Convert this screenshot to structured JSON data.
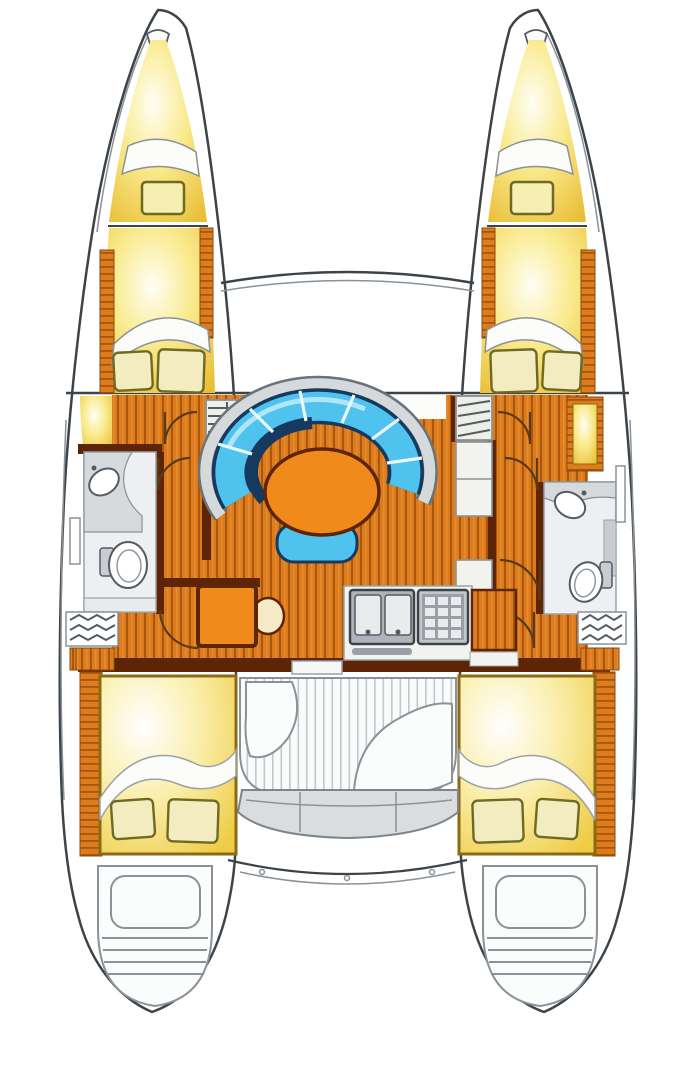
{
  "diagram": {
    "type": "boat-floor-plan",
    "subject": "sailing catamaran interior layout, top-down view",
    "hulls": 2,
    "rooms": [
      {
        "id": "port-forepeak",
        "contents": [
          "anchor-locker-lid",
          "deck-hatch"
        ]
      },
      {
        "id": "starboard-forepeak",
        "contents": [
          "anchor-locker-lid",
          "deck-hatch"
        ]
      },
      {
        "id": "port-forward-cabin",
        "contents": [
          "v-berth",
          "blanket",
          "two-pillows"
        ]
      },
      {
        "id": "starboard-forward-cabin",
        "contents": [
          "v-berth",
          "blanket",
          "two-pillows"
        ]
      },
      {
        "id": "port-head",
        "contents": [
          "sink",
          "counter",
          "toilet"
        ]
      },
      {
        "id": "starboard-head",
        "contents": [
          "sink",
          "counter",
          "toilet"
        ]
      },
      {
        "id": "salon",
        "contents": [
          "curved-settee",
          "oval-table",
          "bench-seat",
          "plank-floor"
        ]
      },
      {
        "id": "nav-station",
        "contents": [
          "chart-table",
          "stool"
        ]
      },
      {
        "id": "galley",
        "contents": [
          "double-sink",
          "stove-grid",
          "counter",
          "cabinet"
        ]
      },
      {
        "id": "port-aft-cabin",
        "contents": [
          "double-berth",
          "sheet-fold",
          "two-pillows"
        ]
      },
      {
        "id": "starboard-aft-cabin",
        "contents": [
          "double-berth",
          "sheet-fold",
          "two-pillows"
        ]
      },
      {
        "id": "cockpit",
        "contents": [
          "slatted-sole",
          "side-seats",
          "transverse-bench"
        ]
      },
      {
        "id": "port-transom",
        "contents": [
          "locker",
          "swim-steps"
        ]
      },
      {
        "id": "starboard-transom",
        "contents": [
          "locker",
          "swim-steps"
        ]
      }
    ],
    "exterior_features": [
      "front-crossbeam",
      "foredeck-gap-between-hulls",
      "aft-beam-with-fittings"
    ]
  },
  "colors": {
    "hull_line": "#3D4449",
    "line_soft": "#8A9298",
    "wood": "#DC7C1C",
    "wood_dark": "#A8560E",
    "wood_light": "#F09A40",
    "wall_brown": "#5E2406",
    "cabin_yellow": "#F3D54F",
    "cabin_yellow_deep": "#E9BE37",
    "cream": "#F3ECC0",
    "pillow_outline": "#6F6A22",
    "settee_blue": "#4FC3EE",
    "settee_blue_light": "#AFE6F7",
    "settee_navy": "#16395F",
    "table_orange": "#F08A1A",
    "bath_floor": "#EDEFF2",
    "counter_gray": "#D6DADD",
    "steel_gray": "#AEB4BA",
    "deck_white": "#FAFBFB",
    "slat_line": "#C2C8CD"
  }
}
